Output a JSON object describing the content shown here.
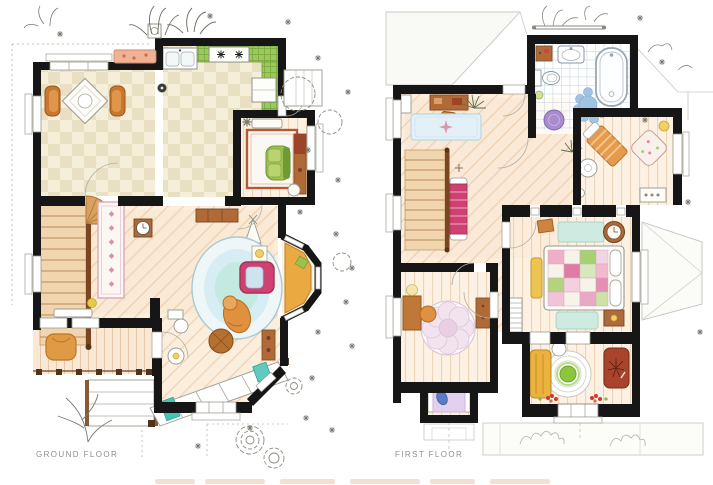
{
  "image": {
    "kind": "hand-drawn watercolor floor plan illustration",
    "width": 713,
    "height": 485,
    "background": "#ffffff"
  },
  "plans": [
    {
      "id": "ground-floor",
      "label": "GROUND FLOOR",
      "rooms": [
        "dining-room",
        "kitchen",
        "study",
        "hallway",
        "staircase",
        "living-room",
        "bay-window",
        "front-room",
        "porch"
      ],
      "furniture": [
        "dining-table",
        "dining-chairs",
        "kitchen-sink",
        "stove",
        "green-tile-counter",
        "refrigerator",
        "study-desk",
        "green-armchair",
        "study-rug",
        "sideboard",
        "runner-rug",
        "stair-winder",
        "clock-table",
        "tepee-lamp",
        "oval-blue-rug",
        "pink-armchair",
        "orange-lounge-chair",
        "round-ottoman",
        "side-table",
        "console-table",
        "bay-window-seat",
        "porch-armchair",
        "porch-steps",
        "teal-step-mat",
        "rose-bush",
        "agave-plants"
      ]
    },
    {
      "id": "first-floor",
      "label": "FIRST FLOOR",
      "rooms": [
        "bathroom",
        "office-nook",
        "landing",
        "staircase",
        "sitting-area",
        "master-bedroom",
        "kids-room",
        "round-rug-room",
        "roof-planes"
      ],
      "furniture": [
        "bathtub",
        "bathroom-sink",
        "toilet",
        "bathroom-cabinet",
        "purple-stool",
        "scallop-rug",
        "towel-rail",
        "office-desk",
        "star-rug",
        "palm-plant",
        "magenta-daybed",
        "closet-wall",
        "patchwork-bed",
        "pillows",
        "foot-bench",
        "teal-rugs",
        "nightstand",
        "round-side-table",
        "attic-ladder",
        "striped-chaise",
        "floral-armchair",
        "vanity-table",
        "spiral-rug",
        "yellow-sofa",
        "red-armchair",
        "flower-rug",
        "kids-desk",
        "alcove-bed",
        "window-flower-boxes"
      ]
    }
  ],
  "palette": {
    "wall": "#161616",
    "paper": "#ffffff",
    "checker_a": "#f5efd9",
    "checker_b": "#e9dfc2",
    "wood_light": "#fbeedd",
    "wood_line": "#eed3b6",
    "kitchen_green": "#9cc95c",
    "stair_tan": "#f0d5ae",
    "rail_brown": "#7a4520",
    "rug_blue": "#d6edf3",
    "armchair_pink": "#ce4170",
    "sofa_orange": "#df913f",
    "teal": "#45c4b5",
    "tile_grid": "#d6e2ec",
    "purple_stool": "#a98bcf",
    "quilt_pink": "#e07ba6",
    "quilt_green": "#aed177",
    "label_gray": "#8f8f8f",
    "roof_line": "#c8c8c2",
    "sketch_line": "#8a8a80"
  }
}
